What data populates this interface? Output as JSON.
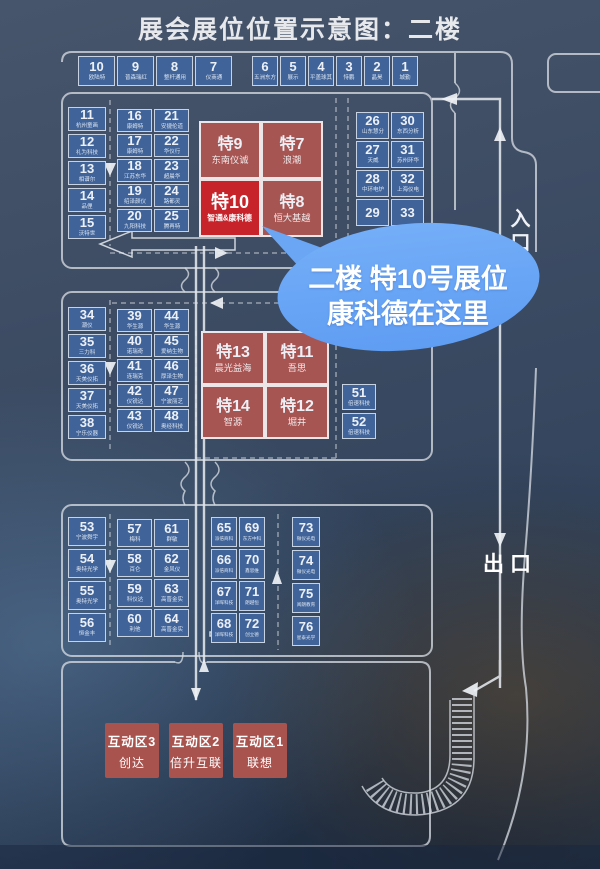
{
  "title": "展会展位位置示意图：二楼",
  "labels": {
    "entrance": "入口",
    "exit": "出口"
  },
  "callout": {
    "line1": "二楼 特10号展位",
    "line2": "康科德在这里"
  },
  "colors": {
    "booth_blue": "#40649a",
    "red_muted": "#a65553",
    "red_highlight": "#c7232b",
    "bubble_blue": "#69a6f4",
    "wall_line": "#d4d9e0",
    "background": "#35465e"
  },
  "top_row": {
    "left": [
      {
        "num": "10",
        "name": "欧陆特"
      },
      {
        "num": "9",
        "name": "普森瑞红"
      },
      {
        "num": "8",
        "name": "整杆通用"
      },
      {
        "num": "7",
        "name": "仪商通"
      }
    ],
    "right": [
      {
        "num": "6",
        "name": "五洲东方"
      },
      {
        "num": "5",
        "name": "展示"
      },
      {
        "num": "4",
        "name": "平盖球其"
      },
      {
        "num": "3",
        "name": "恃鹏"
      },
      {
        "num": "2",
        "name": "晶昊"
      },
      {
        "num": "1",
        "name": "城勤"
      }
    ]
  },
  "block_a": {
    "left_col": [
      {
        "num": "11",
        "name": "杭州童画"
      },
      {
        "num": "12",
        "name": "礼为科技"
      },
      {
        "num": "13",
        "name": "相谱尔"
      },
      {
        "num": "14",
        "name": "品俚"
      },
      {
        "num": "15",
        "name": "沃特世"
      }
    ],
    "grid": [
      {
        "num": "16",
        "name": "康姆特"
      },
      {
        "num": "21",
        "name": "安捷伦道"
      },
      {
        "num": "17",
        "name": "康姆特"
      },
      {
        "num": "22",
        "name": "华仪行"
      },
      {
        "num": "18",
        "name": "江苏东华"
      },
      {
        "num": "23",
        "name": "超晨华"
      },
      {
        "num": "19",
        "name": "绍泽颜仪"
      },
      {
        "num": "24",
        "name": "路都灵"
      },
      {
        "num": "20",
        "name": "九阳科技"
      },
      {
        "num": "25",
        "name": "腾再特"
      }
    ]
  },
  "special_top": [
    {
      "num": "特9",
      "name": "东南仪诚",
      "highlight": false
    },
    {
      "num": "特7",
      "name": "浪潮",
      "highlight": false
    },
    {
      "num": "特10",
      "name": "智通&康科德",
      "highlight": true
    },
    {
      "num": "特8",
      "name": "恒大基越",
      "highlight": false
    }
  ],
  "block_b": {
    "grid": [
      {
        "num": "26",
        "name": "山东慧分"
      },
      {
        "num": "30",
        "name": "东西分析"
      },
      {
        "num": "27",
        "name": "天威"
      },
      {
        "num": "31",
        "name": "苏州环华"
      },
      {
        "num": "28",
        "name": "中环电炉"
      },
      {
        "num": "32",
        "name": "上海仪电"
      },
      {
        "num": "29",
        "name": ""
      },
      {
        "num": "33",
        "name": ""
      }
    ]
  },
  "block_c": {
    "left_col": [
      {
        "num": "34",
        "name": "潮仪"
      },
      {
        "num": "35",
        "name": "三力科"
      },
      {
        "num": "36",
        "name": "天美仪拓"
      },
      {
        "num": "37",
        "name": "天美仪拓"
      },
      {
        "num": "38",
        "name": "宁乐仪器"
      }
    ],
    "grid": [
      {
        "num": "39",
        "name": "华生源"
      },
      {
        "num": "44",
        "name": "华生源"
      },
      {
        "num": "40",
        "name": "诺瑞奇"
      },
      {
        "num": "45",
        "name": "爱纳生物"
      },
      {
        "num": "41",
        "name": "连瑞克"
      },
      {
        "num": "46",
        "name": "厚泽生物"
      },
      {
        "num": "42",
        "name": "仪锐达"
      },
      {
        "num": "47",
        "name": "宁波丽芝"
      },
      {
        "num": "43",
        "name": "仪锐达"
      },
      {
        "num": "48",
        "name": "奥经科技"
      }
    ]
  },
  "special_mid": [
    {
      "num": "特13",
      "name": "晨光益海",
      "highlight": false
    },
    {
      "num": "特11",
      "name": "吾思",
      "highlight": false
    },
    {
      "num": "特14",
      "name": "智源",
      "highlight": false
    },
    {
      "num": "特12",
      "name": "堀井",
      "highlight": false
    }
  ],
  "side_col": [
    {
      "num": "51",
      "name": "倍速科技"
    },
    {
      "num": "52",
      "name": "倍速科技"
    }
  ],
  "block_d": {
    "left_col": [
      {
        "num": "53",
        "name": "宁波舜宇"
      },
      {
        "num": "54",
        "name": "奥特光学"
      },
      {
        "num": "55",
        "name": "奥特光学"
      },
      {
        "num": "56",
        "name": "恒金丰"
      }
    ],
    "grid1": [
      {
        "num": "57",
        "name": "梅科"
      },
      {
        "num": "61",
        "name": "群敏"
      },
      {
        "num": "58",
        "name": "百仑"
      },
      {
        "num": "62",
        "name": "金风仪"
      },
      {
        "num": "59",
        "name": "科仪达"
      },
      {
        "num": "63",
        "name": "高晋金实"
      },
      {
        "num": "60",
        "name": "利他"
      },
      {
        "num": "64",
        "name": "高晋金实"
      }
    ],
    "grid2": [
      {
        "num": "65",
        "name": "派倍商科"
      },
      {
        "num": "69",
        "name": "东方中科"
      },
      {
        "num": "66",
        "name": "派倍商科"
      },
      {
        "num": "70",
        "name": "鑫思维"
      },
      {
        "num": "67",
        "name": "洋晖科技"
      },
      {
        "num": "71",
        "name": "朗越恒"
      },
      {
        "num": "68",
        "name": "洋晖科技"
      },
      {
        "num": "72",
        "name": "创立德"
      }
    ],
    "right_col": [
      {
        "num": "73",
        "name": "微仪光电"
      },
      {
        "num": "74",
        "name": "微仪光电"
      },
      {
        "num": "75",
        "name": "阅朗教育"
      },
      {
        "num": "76",
        "name": "星泰光学"
      }
    ]
  },
  "zones": [
    {
      "line1": "互动区3",
      "line2": "创达"
    },
    {
      "line1": "互动区2",
      "line2": "倍升互联"
    },
    {
      "line1": "互动区1",
      "line2": "联想"
    }
  ]
}
